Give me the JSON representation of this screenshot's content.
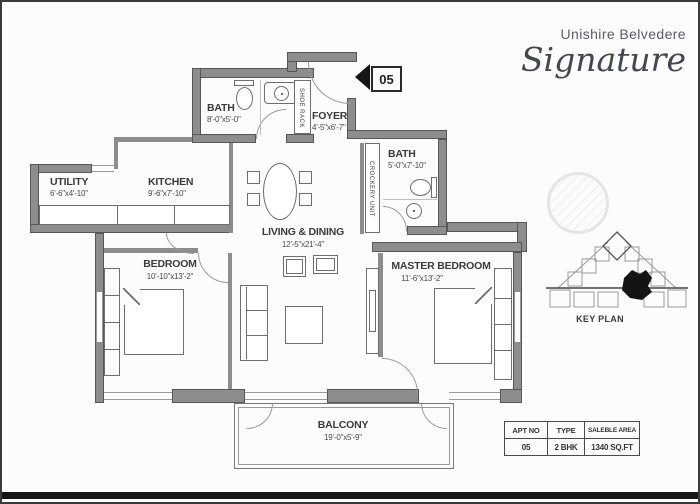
{
  "title": {
    "brand": "Unishire Belvedere",
    "logotype": "Signature"
  },
  "entry_marker": {
    "number": "05"
  },
  "rooms": [
    {
      "key": "bath-top",
      "name": "BATH",
      "dims": "8'-0\"x5'-0\""
    },
    {
      "key": "foyer",
      "name": "FOYER",
      "dims": "4'-5\"x6'-7\""
    },
    {
      "key": "utility",
      "name": "UTILITY",
      "dims": "6'-6\"x4'-10\""
    },
    {
      "key": "kitchen",
      "name": "KITCHEN",
      "dims": "9'-6\"x7'-10\""
    },
    {
      "key": "bath-master",
      "name": "BATH",
      "dims": "5'-0\"x7'-10\""
    },
    {
      "key": "living-dining",
      "name": "LIVING & DINING",
      "dims": "12'-5\"x21'-4\""
    },
    {
      "key": "bedroom",
      "name": "BEDROOM",
      "dims": "10'-10\"x13'-2\""
    },
    {
      "key": "master-bedroom",
      "name": "MASTER BEDROOM",
      "dims": "11'-6\"x13'-2\""
    },
    {
      "key": "balcony",
      "name": "BALCONY",
      "dims": "19'-0\"x5'-9\""
    }
  ],
  "fixtures": {
    "shoe_rack": "SHOE RACK",
    "crockery_unit": "CROCKERY UNIT"
  },
  "key_plan": {
    "label": "KEY PLAN"
  },
  "summary_table": {
    "headers": [
      "APT NO",
      "TYPE",
      "SALEBLE AREA"
    ],
    "row": [
      "05",
      "2 BHK",
      "1340 SQ.FT"
    ]
  },
  "colors": {
    "wall": "#8d8d8d",
    "wall_edge": "#575757",
    "line": "#6e6e6e",
    "text": "#3b3b3b",
    "accent_black": "#161616"
  }
}
